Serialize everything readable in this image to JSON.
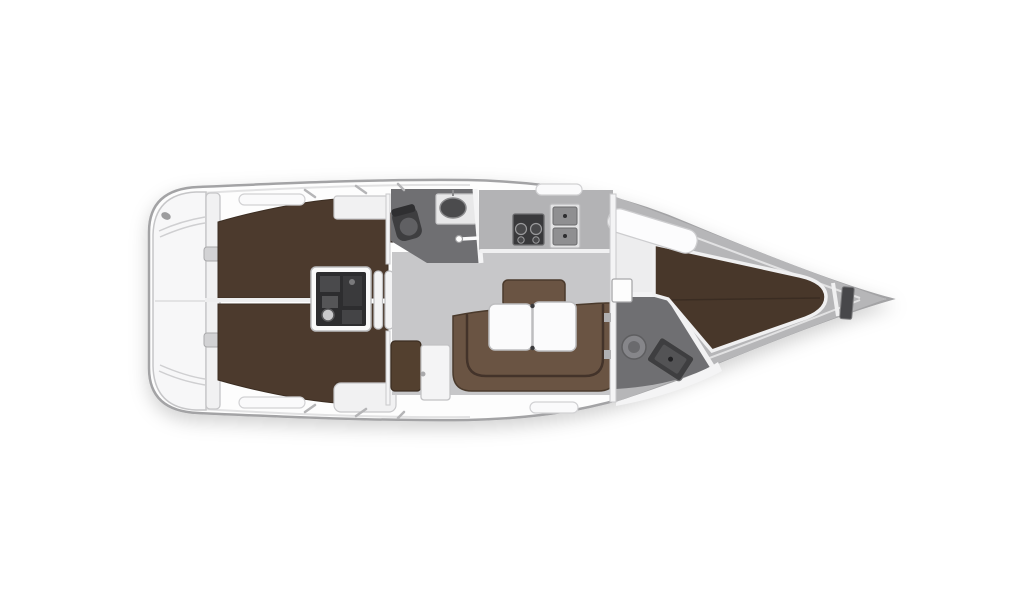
{
  "diagram": {
    "type": "yacht-interior-floor-plan",
    "orientation": "bow-right-top-view",
    "regions": [
      "swim-platform",
      "transom-locker",
      "aft-cabin-top",
      "aft-cabin-bottom",
      "engine-compartment",
      "companionway-steps",
      "aft-head",
      "galley",
      "salon",
      "nav-station",
      "forward-head",
      "forward-cabin",
      "anchor-locker"
    ],
    "colors": {
      "hull_fill": "#fdfdfd",
      "hull_stroke": "#a3a3a5",
      "platform_fill": "#f7f7f8",
      "deck_gray": "#b6b6b8",
      "floor_gray": "#c7c7c9",
      "counter_gray": "#b3b3b5",
      "head_floor": "#6f6f72",
      "berth_brown": "#4c3a2d",
      "vberth_brown": "#48372a",
      "settee_brown": "#6a5443",
      "settee_line": "#43332a",
      "nav_seat_brown": "#53402f",
      "engine_dark": "#2d2d2f",
      "fixture_dark": "#3e3e40",
      "table_white": "#fbfbfc",
      "cabinet_white": "#f1f1f2"
    }
  }
}
